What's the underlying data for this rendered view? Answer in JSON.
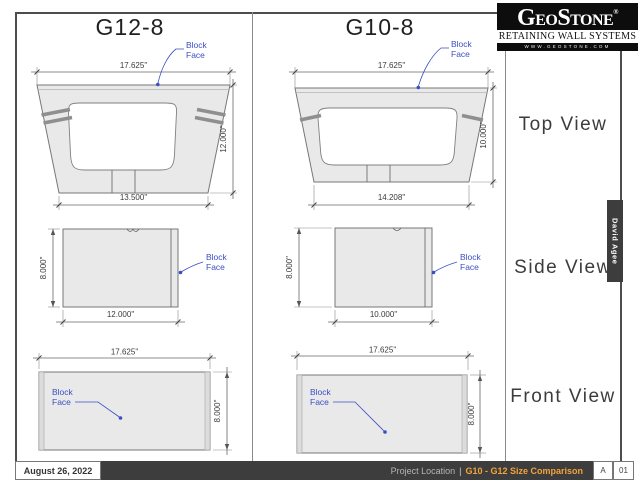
{
  "sheet": {
    "g12_title": "G12-8",
    "g10_title": "G10-8"
  },
  "views": {
    "top": "Top View",
    "side": "Side View",
    "front": "Front View"
  },
  "annotations": {
    "block_face_line1": "Block",
    "block_face_line2": "Face"
  },
  "dimensions": {
    "g12_top": {
      "width": "17.625\"",
      "bottom_width": "13.500\"",
      "depth": "12.000\""
    },
    "g10_top": {
      "width": "17.625\"",
      "bottom_width": "14.208\"",
      "depth": "10.000\""
    },
    "g12_side": {
      "height": "8.000\"",
      "width": "12.000\""
    },
    "g10_side": {
      "height": "8.000\"",
      "width": "10.000\""
    },
    "g12_front": {
      "width": "17.625\"",
      "height": "8.000\""
    },
    "g10_front": {
      "width": "17.625\"",
      "height": "8.000\""
    }
  },
  "logo": {
    "part_g": "G",
    "part_eo": "EO",
    "part_s": "S",
    "part_tone": "TONE",
    "registered": "®",
    "tagline": "RETAINING WALL SYSTEMS",
    "website": "WWW.GEOSTONE.COM"
  },
  "author_tab": {
    "name": "David Agee"
  },
  "title_block": {
    "date": "August 26, 2022",
    "location_label": "Project Location",
    "separator": "|",
    "sheet_title": "G10 - G12 Size Comparison",
    "revision": "A",
    "sheet_number": "01"
  },
  "colors": {
    "annotation_blue": "#3b4fc4",
    "accent_orange": "#f2a33c",
    "block_fill": "#e9e9e9",
    "bar_dark": "#3d3d3d"
  }
}
